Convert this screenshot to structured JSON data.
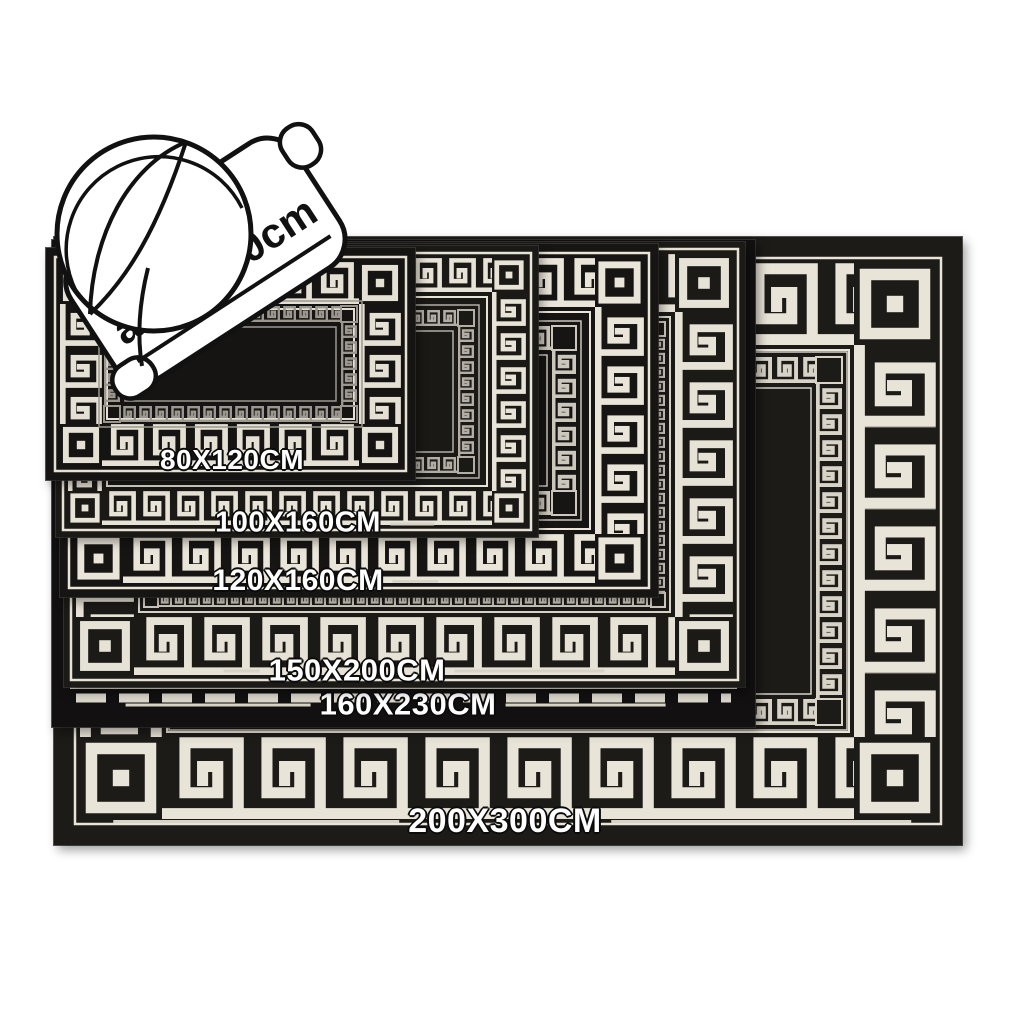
{
  "diagram": {
    "rolled_rug_note": "about 80cm",
    "sizes": [
      {
        "label": "80X120CM"
      },
      {
        "label": "100X160CM"
      },
      {
        "label": "120X160CM"
      },
      {
        "label": "150X200CM"
      },
      {
        "label": "160X230CM"
      },
      {
        "label": "200X300CM"
      }
    ]
  },
  "colors": {
    "background": "#ffffff",
    "rug_black": "#1a1815",
    "pattern_cream": "#e8e3d7",
    "inner_pattern_grey": "#9b978f",
    "label_text": "#ffffff",
    "outline_black": "#111111"
  }
}
